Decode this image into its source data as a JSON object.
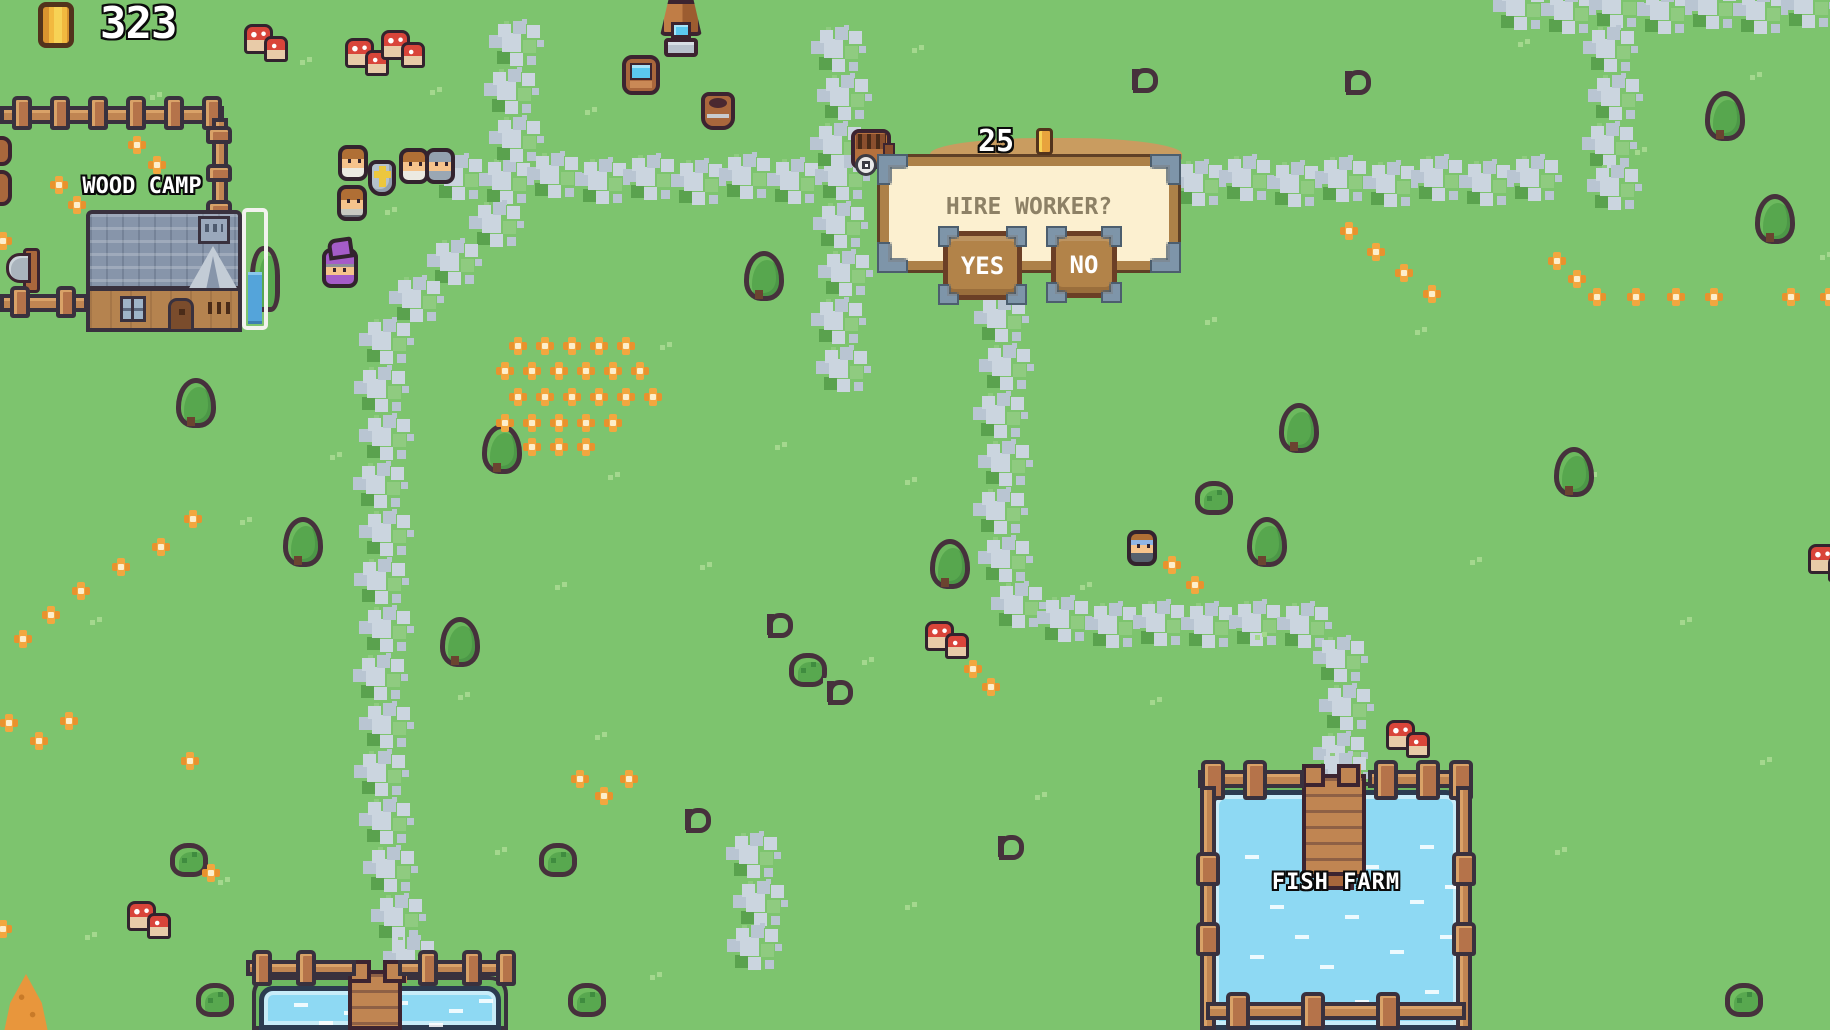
{
  "hud": {
    "coin_count": "323",
    "coin_icon": "gold-coin"
  },
  "labels": {
    "wood_camp": "WOOD CAMP",
    "fish_farm": "FISH FARM"
  },
  "dialog": {
    "title": "HIRE WORKER?",
    "cost": "25",
    "cost_coin_icon": "gold-coin",
    "yes_label": "YES",
    "no_label": "NO"
  },
  "colors": {
    "grass": "#7dc46e",
    "path_light": "#cbd5df",
    "path_mid": "#b9c5d2",
    "path_green": "#8fcb80",
    "panel_fill": "#fcf0d0",
    "panel_border": "#ad8148",
    "bracket_steel": "#7e95a9",
    "button_brown": "#b28349",
    "water_blue": "#8ed9f3",
    "fence_brown": "#c08552",
    "title_text": "#8d8166",
    "progress_fill": "#54a4da",
    "coin_gold": "#e8a33d"
  },
  "decorations": {
    "paths": [
      [
        440,
        158
      ],
      [
        488,
        162
      ],
      [
        536,
        156
      ],
      [
        584,
        162
      ],
      [
        632,
        158
      ],
      [
        680,
        163
      ],
      [
        728,
        157
      ],
      [
        776,
        162
      ],
      [
        824,
        158
      ],
      [
        1180,
        164
      ],
      [
        1228,
        159
      ],
      [
        1276,
        165
      ],
      [
        1324,
        160
      ],
      [
        1372,
        165
      ],
      [
        1420,
        159
      ],
      [
        1468,
        164
      ],
      [
        1516,
        159
      ],
      [
        820,
        30
      ],
      [
        826,
        78
      ],
      [
        819,
        126
      ],
      [
        822,
        206
      ],
      [
        827,
        254
      ],
      [
        820,
        302
      ],
      [
        825,
        350
      ],
      [
        498,
        24
      ],
      [
        493,
        72
      ],
      [
        498,
        120
      ],
      [
        478,
        205
      ],
      [
        436,
        243
      ],
      [
        398,
        280
      ],
      [
        368,
        322
      ],
      [
        363,
        370
      ],
      [
        368,
        418
      ],
      [
        362,
        466
      ],
      [
        368,
        514
      ],
      [
        363,
        562
      ],
      [
        368,
        610
      ],
      [
        362,
        658
      ],
      [
        368,
        706
      ],
      [
        363,
        754
      ],
      [
        368,
        802
      ],
      [
        372,
        850
      ],
      [
        380,
        898
      ],
      [
        392,
        940
      ],
      [
        983,
        300
      ],
      [
        988,
        348
      ],
      [
        982,
        396
      ],
      [
        987,
        444
      ],
      [
        982,
        492
      ],
      [
        987,
        540
      ],
      [
        1000,
        586
      ],
      [
        1046,
        600
      ],
      [
        1094,
        606
      ],
      [
        1142,
        604
      ],
      [
        1190,
        606
      ],
      [
        1238,
        604
      ],
      [
        1286,
        606
      ],
      [
        1322,
        640
      ],
      [
        1328,
        688
      ],
      [
        1322,
        736
      ],
      [
        1324,
        756
      ],
      [
        1502,
        -12
      ],
      [
        1550,
        -8
      ],
      [
        1598,
        -14
      ],
      [
        1646,
        -8
      ],
      [
        1694,
        -13
      ],
      [
        1742,
        -8
      ],
      [
        1790,
        -14
      ],
      [
        1592,
        30
      ],
      [
        1597,
        78
      ],
      [
        1591,
        126
      ],
      [
        1596,
        168
      ],
      [
        735,
        836
      ],
      [
        742,
        884
      ],
      [
        736,
        928
      ]
    ],
    "trees": [
      [
        176,
        378
      ],
      [
        482,
        424
      ],
      [
        283,
        517
      ],
      [
        440,
        617
      ],
      [
        744,
        251
      ],
      [
        930,
        539
      ],
      [
        1247,
        517
      ],
      [
        1279,
        403
      ],
      [
        1705,
        91
      ],
      [
        1755,
        194
      ],
      [
        1554,
        447
      ]
    ],
    "bushes": [
      [
        1195,
        481
      ],
      [
        196,
        983
      ],
      [
        568,
        983
      ],
      [
        1725,
        983
      ],
      [
        789,
        653
      ],
      [
        539,
        843
      ],
      [
        170,
        843
      ]
    ],
    "sprouts": [
      [
        762,
        611
      ],
      [
        822,
        678
      ],
      [
        680,
        806
      ],
      [
        993,
        833
      ],
      [
        1340,
        68
      ],
      [
        1127,
        66
      ]
    ],
    "flowers": [
      [
        128,
        136
      ],
      [
        148,
        156
      ],
      [
        50,
        176
      ],
      [
        68,
        196
      ],
      [
        -6,
        232
      ],
      [
        509,
        337
      ],
      [
        536,
        337
      ],
      [
        563,
        337
      ],
      [
        590,
        337
      ],
      [
        617,
        337
      ],
      [
        496,
        362
      ],
      [
        523,
        362
      ],
      [
        550,
        362
      ],
      [
        577,
        362
      ],
      [
        604,
        362
      ],
      [
        631,
        362
      ],
      [
        509,
        388
      ],
      [
        536,
        388
      ],
      [
        563,
        388
      ],
      [
        590,
        388
      ],
      [
        617,
        388
      ],
      [
        644,
        388
      ],
      [
        496,
        414
      ],
      [
        523,
        414
      ],
      [
        550,
        414
      ],
      [
        577,
        414
      ],
      [
        604,
        414
      ],
      [
        523,
        438
      ],
      [
        550,
        438
      ],
      [
        577,
        438
      ],
      [
        184,
        510
      ],
      [
        152,
        538
      ],
      [
        112,
        558
      ],
      [
        72,
        582
      ],
      [
        42,
        606
      ],
      [
        14,
        630
      ],
      [
        0,
        714
      ],
      [
        30,
        732
      ],
      [
        60,
        712
      ],
      [
        1163,
        556
      ],
      [
        1186,
        576
      ],
      [
        964,
        660
      ],
      [
        982,
        678
      ],
      [
        1340,
        222
      ],
      [
        1367,
        243
      ],
      [
        1395,
        264
      ],
      [
        1423,
        285
      ],
      [
        1548,
        252
      ],
      [
        1568,
        270
      ],
      [
        1588,
        288
      ],
      [
        1627,
        288
      ],
      [
        1667,
        288
      ],
      [
        1705,
        288
      ],
      [
        1782,
        288
      ],
      [
        1820,
        288
      ],
      [
        571,
        770
      ],
      [
        595,
        787
      ],
      [
        620,
        770
      ],
      [
        202,
        864
      ],
      [
        -6,
        920
      ],
      [
        181,
        752
      ]
    ],
    "mushrooms": [
      [
        244,
        24
      ],
      [
        345,
        38
      ],
      [
        381,
        30
      ],
      [
        127,
        901
      ],
      [
        925,
        621
      ],
      [
        1386,
        720
      ],
      [
        1808,
        544
      ]
    ],
    "tufts": [
      [
        150,
        95
      ],
      [
        300,
        60
      ],
      [
        430,
        90
      ],
      [
        385,
        210
      ],
      [
        585,
        110
      ],
      [
        912,
        48
      ],
      [
        1518,
        42
      ],
      [
        1750,
        75
      ],
      [
        1635,
        150
      ],
      [
        1820,
        255
      ],
      [
        168,
        310
      ],
      [
        240,
        520
      ],
      [
        90,
        620
      ],
      [
        330,
        455
      ],
      [
        660,
        345
      ],
      [
        608,
        475
      ],
      [
        700,
        565
      ],
      [
        905,
        480
      ],
      [
        862,
        660
      ],
      [
        1080,
        585
      ],
      [
        1255,
        635
      ],
      [
        1150,
        700
      ],
      [
        1035,
        795
      ],
      [
        595,
        735
      ],
      [
        495,
        850
      ],
      [
        218,
        880
      ],
      [
        85,
        935
      ],
      [
        650,
        975
      ],
      [
        905,
        905
      ],
      [
        1585,
        475
      ],
      [
        1680,
        620
      ],
      [
        1760,
        760
      ],
      [
        1555,
        850
      ],
      [
        1300,
        440
      ],
      [
        1415,
        330
      ],
      [
        1470,
        560
      ],
      [
        555,
        585
      ],
      [
        775,
        445
      ],
      [
        1205,
        320
      ],
      [
        458,
        695
      ]
    ],
    "water_dashes_fish_farm": [
      [
        30,
        60
      ],
      [
        90,
        45
      ],
      [
        150,
        70
      ],
      [
        205,
        50
      ],
      [
        55,
        110
      ],
      [
        130,
        120
      ],
      [
        195,
        105
      ],
      [
        35,
        160
      ],
      [
        105,
        170
      ],
      [
        175,
        155
      ],
      [
        225,
        140
      ],
      [
        60,
        210
      ],
      [
        140,
        205
      ],
      [
        210,
        195
      ],
      [
        40,
        250
      ],
      [
        120,
        245
      ],
      [
        190,
        240
      ],
      [
        80,
        140
      ],
      [
        230,
        90
      ]
    ],
    "water_dashes_bottom_pond": [
      [
        30,
        12
      ],
      [
        80,
        20
      ],
      [
        130,
        10
      ],
      [
        185,
        18
      ],
      [
        215,
        8
      ],
      [
        55,
        30
      ],
      [
        165,
        32
      ]
    ]
  }
}
